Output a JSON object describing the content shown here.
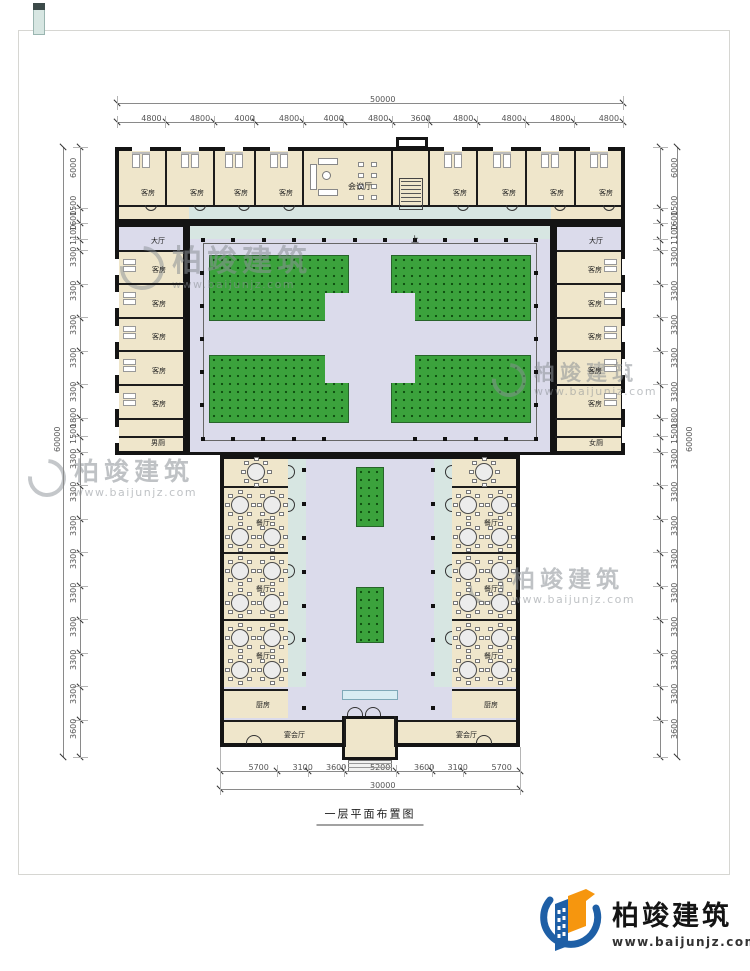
{
  "page": {
    "title": "一层平面布置图"
  },
  "branding": {
    "brand": "柏竣建筑",
    "site": "www.baijunjz.com"
  },
  "dimensions": {
    "top": {
      "total": "50000",
      "segments": [
        "4800",
        "4800",
        "4000",
        "4800",
        "4000",
        "4800",
        "3600",
        "4800",
        "4800",
        "4800",
        "4800"
      ]
    },
    "bottom": {
      "total": "30000",
      "segments": [
        "5700",
        "3100",
        "3600",
        "5200",
        "3600",
        "3100",
        "5700"
      ]
    },
    "left": {
      "total": "60000",
      "segments": [
        "6000",
        "1500",
        "1600",
        "1100",
        "3300",
        "3300",
        "3300",
        "3300",
        "3300",
        "1800",
        "1500",
        "3300",
        "3300",
        "3300",
        "3300",
        "3300",
        "3300",
        "3300",
        "3300",
        "3600"
      ]
    },
    "right": {
      "total": "60000",
      "segments": [
        "6000",
        "1500",
        "1600",
        "1100",
        "3300",
        "3300",
        "3300",
        "3300",
        "3300",
        "1800",
        "1500",
        "3300",
        "3300",
        "3300",
        "3300",
        "3300",
        "3300",
        "3300",
        "3300",
        "3600"
      ]
    }
  },
  "rooms": {
    "guest": "客房",
    "hall": "大厅",
    "meeting": "会议厅",
    "dining": "餐厅",
    "kitchen": "厨房",
    "banquet": "宴会厅",
    "men_wc": "男厕",
    "women_wc": "女厕",
    "stairs_up": "上"
  },
  "colors": {
    "room_fill": "#efe6cb",
    "corridor_fill": "#dbdbeb",
    "lawn_green": "#3ba23c",
    "porch_teal": "#d7e6e2",
    "wall": "#141414",
    "logo_blue": "#1e5fa6",
    "logo_orange": "#f6960e"
  }
}
